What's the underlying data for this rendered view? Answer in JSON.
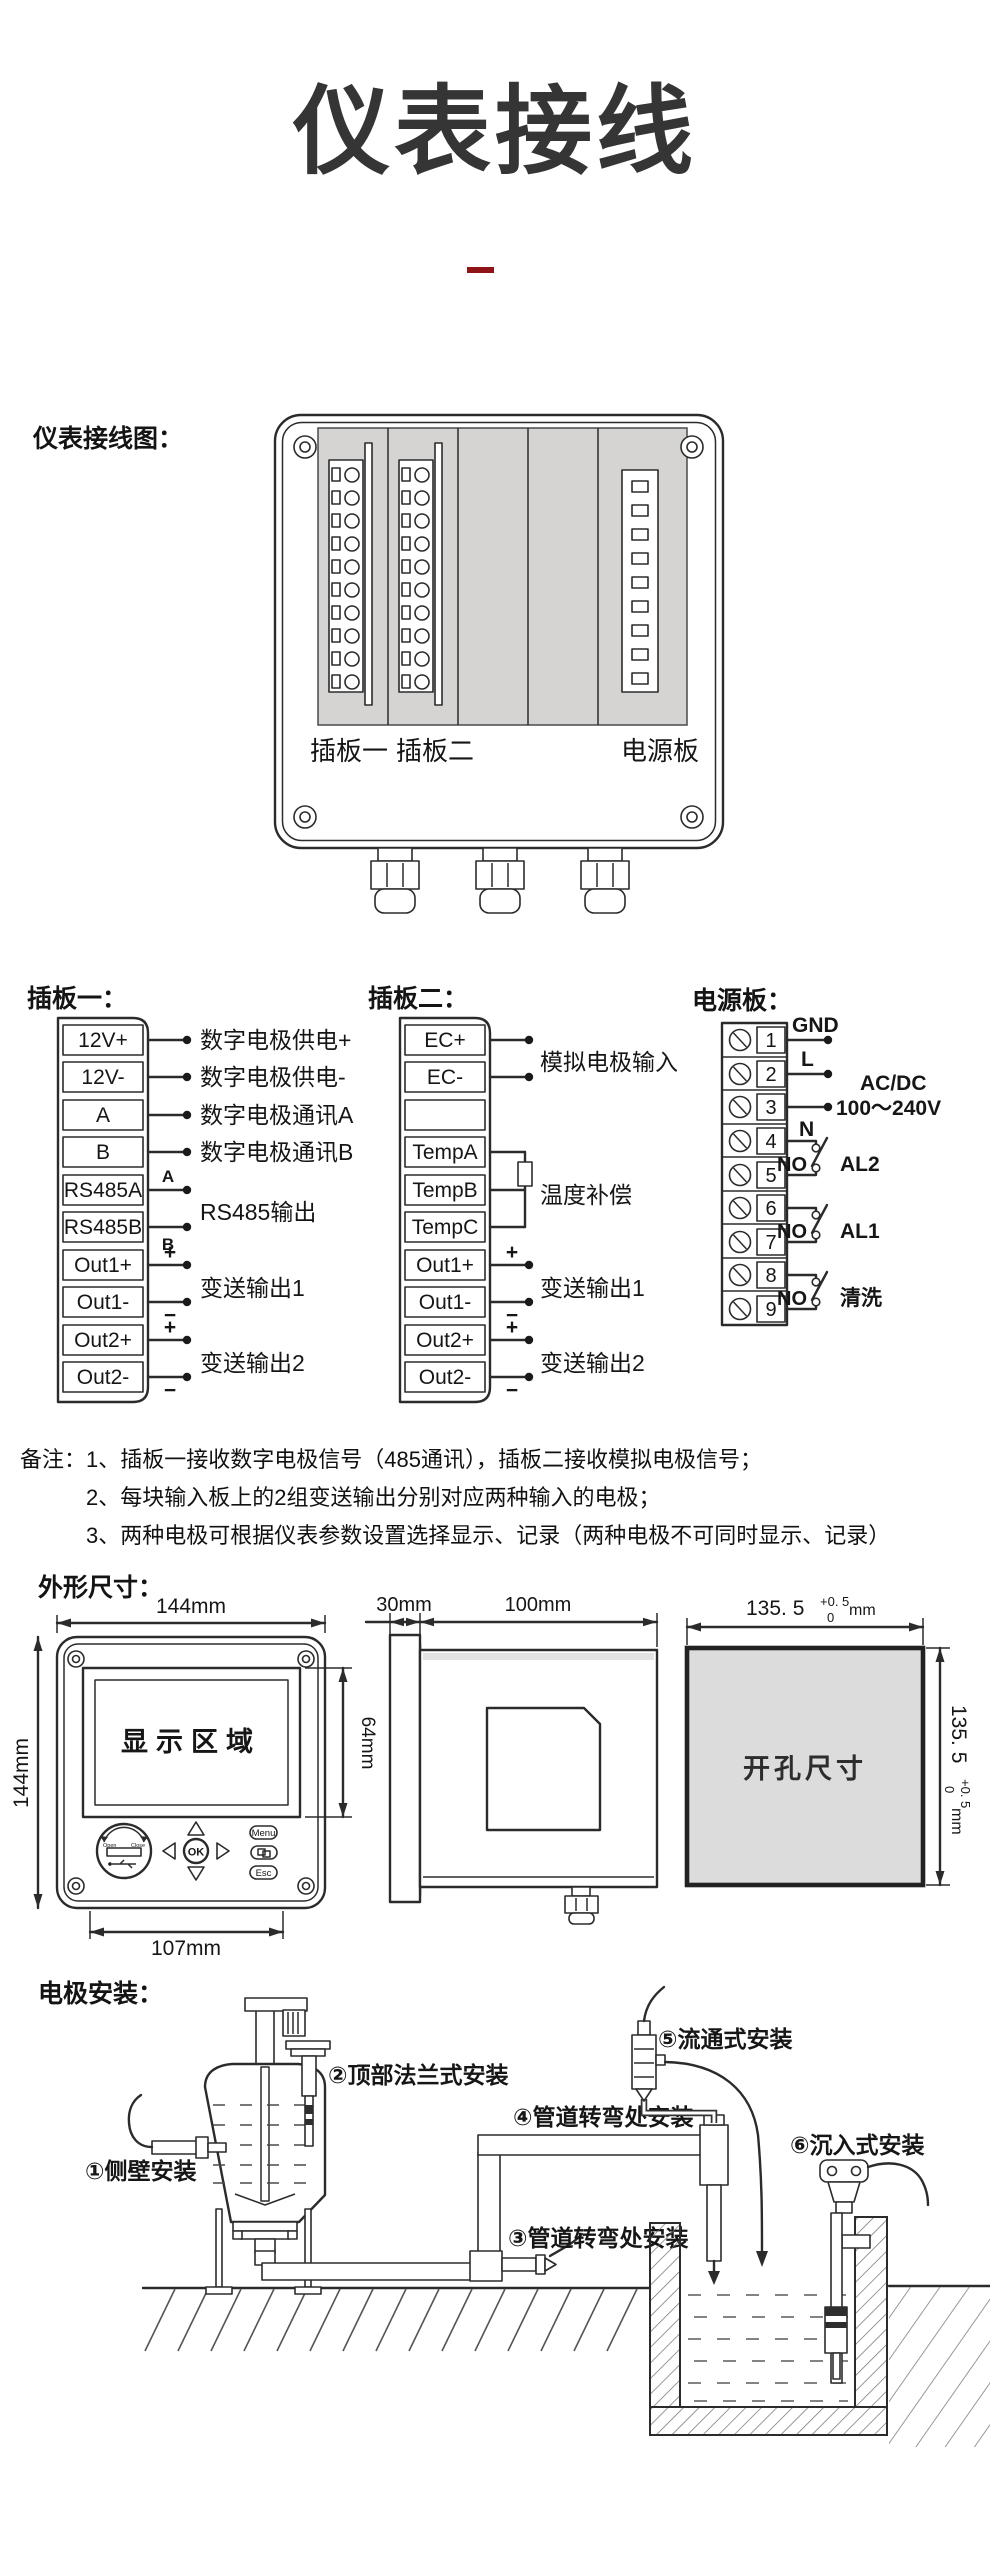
{
  "title": "仪表接线",
  "labels": {
    "wiring": "仪表接线图：",
    "board1": "插板一：",
    "board2": "插板二：",
    "power": "电源板：",
    "notes_head": "备注：",
    "dims": "外形尺寸：",
    "install": "电极安装："
  },
  "device": {
    "slot1": "插板一",
    "slot2": "插板二",
    "slot3": "电源板"
  },
  "board1": {
    "t": [
      "12V+",
      "12V-",
      "A",
      "B",
      "RS485A",
      "RS485B",
      "Out1+",
      "Out1-",
      "Out2+",
      "Out2-"
    ],
    "a1": "数字电极供电+",
    "a2": "数字电极供电-",
    "a3": "数字电极通讯A",
    "a4": "数字电极通讯B",
    "a5": "RS485输出",
    "a6": "变送输出1",
    "a7": "变送输出2",
    "mA": "A",
    "mB": "B",
    "plus": "+",
    "minus": "−"
  },
  "board2": {
    "t": [
      "EC+",
      "EC-",
      "",
      "TempA",
      "TempB",
      "TempC",
      "Out1+",
      "Out1-",
      "Out2+",
      "Out2-"
    ],
    "a1": "模拟电极输入",
    "a2": "温度补偿",
    "a3": "变送输出1",
    "a4": "变送输出2",
    "plus": "+",
    "minus": "−"
  },
  "power": {
    "t": [
      "1",
      "2",
      "3",
      "4",
      "5",
      "6",
      "7",
      "8",
      "9"
    ],
    "gnd": "GND",
    "l": "L",
    "n": "N",
    "ac1": "AC/DC",
    "ac2": "100～240V",
    "no": "NO",
    "al2": "AL2",
    "al1": "AL1",
    "wash": "清洗"
  },
  "notes": [
    "1、插板一接收数字电极信号（485通讯），插板二接收模拟电极信号；",
    "2、每块输入板上的2组变送输出分别对应两种输入的电极；",
    "3、两种电极可根据仪表参数设置选择显示、记录（两种电极不可同时显示、记录）"
  ],
  "front": {
    "top": "144mm",
    "left": "144mm",
    "screen_h": "64mm",
    "bottom": "107mm",
    "screen": "显示区域",
    "menu": "Menu",
    "ok": "OK",
    "esc": "Esc",
    "open": "Open",
    "close": "Close"
  },
  "side": {
    "bezel": "30mm",
    "depth": "100mm"
  },
  "cutout": {
    "label": "开孔尺寸",
    "v": "135. 5",
    "tp": "+0. 5",
    "tz": "0",
    "u": "mm"
  },
  "install": {
    "i1": "①侧壁安装",
    "i2": "②顶部法兰式安装",
    "i3": "③管道转弯处安装",
    "i4": "④管道转弯处安装",
    "i5": "⑤流通式安装",
    "i6": "⑥沉入式安装"
  },
  "colors": {
    "accent": "#8e1418",
    "ink": "#2b2b2b",
    "panel_gray": "#d6d4d2"
  }
}
